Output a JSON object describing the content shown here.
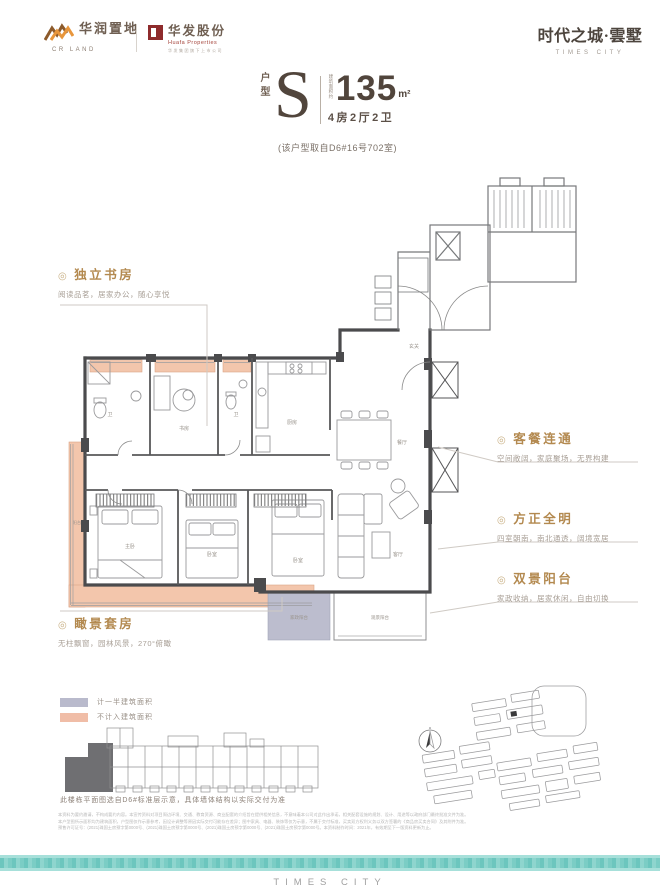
{
  "header": {
    "crland": {
      "name": "华润置地",
      "sub": "CR LAND"
    },
    "huafa": {
      "name": "华发股份",
      "sub": "Huafa Properties",
      "tagline": "华发集团旗下上市公司"
    },
    "brand": {
      "title": "时代之城·雲墅",
      "subtitle": "TIMES CITY"
    }
  },
  "unit": {
    "type_label": "户型",
    "type_letter": "S",
    "area_note": "建筑面积约",
    "area": "135",
    "area_unit": "m²",
    "layout": "4房2厅2卫",
    "source": "(该户型取自D6#16号702室)"
  },
  "icons": {
    "callout_bullet": "◎"
  },
  "callouts": {
    "study": {
      "title": "独立书房",
      "desc": "阅读品茗，居家办公，随心享悦"
    },
    "dining": {
      "title": "客餐连通",
      "desc": "空间敞阔，家庭聚场，无界构建"
    },
    "bright": {
      "title": "方正全明",
      "desc": "四室朝南，南北通透，阔境宽居"
    },
    "dual_balcony": {
      "title": "双景阳台",
      "desc": "家政收纳，居家休闲，自由切换"
    },
    "view_suite": {
      "title": "瞰景套房",
      "desc": "无柱飘窗，园林风景，270°俯瞰"
    }
  },
  "legend": {
    "half_area": {
      "label": "计一半建筑面积",
      "color": "#b9bacc"
    },
    "excluded": {
      "label": "不计入建筑面积",
      "color": "#f0bda7"
    }
  },
  "rooms": {
    "study": "书房",
    "bath": "卫",
    "bedroom": "卧室",
    "master": "主卧",
    "kitchen": "厨房",
    "dining": "餐厅",
    "living": "客厅",
    "foyer": "玄关",
    "service_balcony": "家政阳台",
    "view_balcony": "观景阳台",
    "balcony": "阳台"
  },
  "keyplan": {
    "caption": "此楼栋平面图选自D6#标准层示意，具体墙体结构以实际交付为准"
  },
  "disclaimer": {
    "line1": "本资料为要约邀请，不构成要约内容。本宣传资料对项目周边环境、交通、教育资源、商业配套的介绍旨在提供相关信息，不意味着本公司对此作出承诺，相关配套设施的规划、设计、用途等以政府部门最终批准文件为准。",
    "line2": "本户型图所示面积均为建筑面积，户型图仅作示意参考，因设计调整等原因实际交付可能存在差异；图中家具、电器、装饰等仅为示意，不属于交付标准，买卖双方权利义务以双方签署的《商品房买卖合同》及其附件为准。",
    "line3": "预售许可证号：(2021)珠国土房预字第0000号、(2021)珠国土房预字第0000号、(2021)珠国土房预字第0000号、(2021)珠国土房预字第0000号。本资料制作时间：2021年，有效期至下一版资料更新为止。"
  },
  "footer": {
    "brand": "TIMES CITY"
  },
  "colors": {
    "accent_gold": "#b3894f",
    "pink_area": "#f3c6ac",
    "lavender_area": "#b9bacc",
    "teal_band": "#7bcdc5",
    "wall": "#4b4b4d"
  }
}
